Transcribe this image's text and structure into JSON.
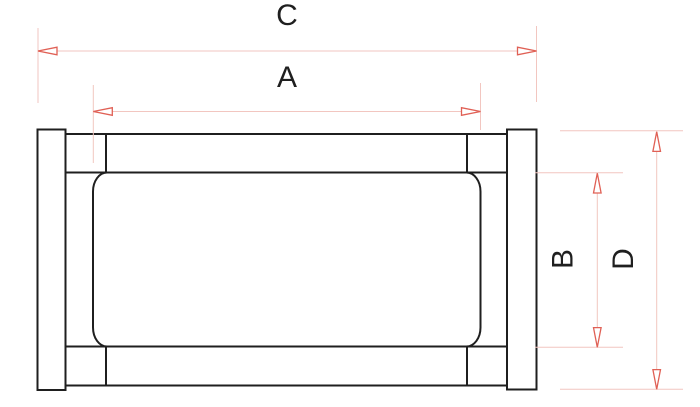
{
  "labels": {
    "C": "C",
    "A": "A",
    "B": "B",
    "D": "D"
  },
  "colors": {
    "background": "#ffffff",
    "part_line": "#1f1f1f",
    "dimension_line": "#f2c6c0",
    "arrow": "#e06055",
    "label_text": "#1f1f1f"
  }
}
